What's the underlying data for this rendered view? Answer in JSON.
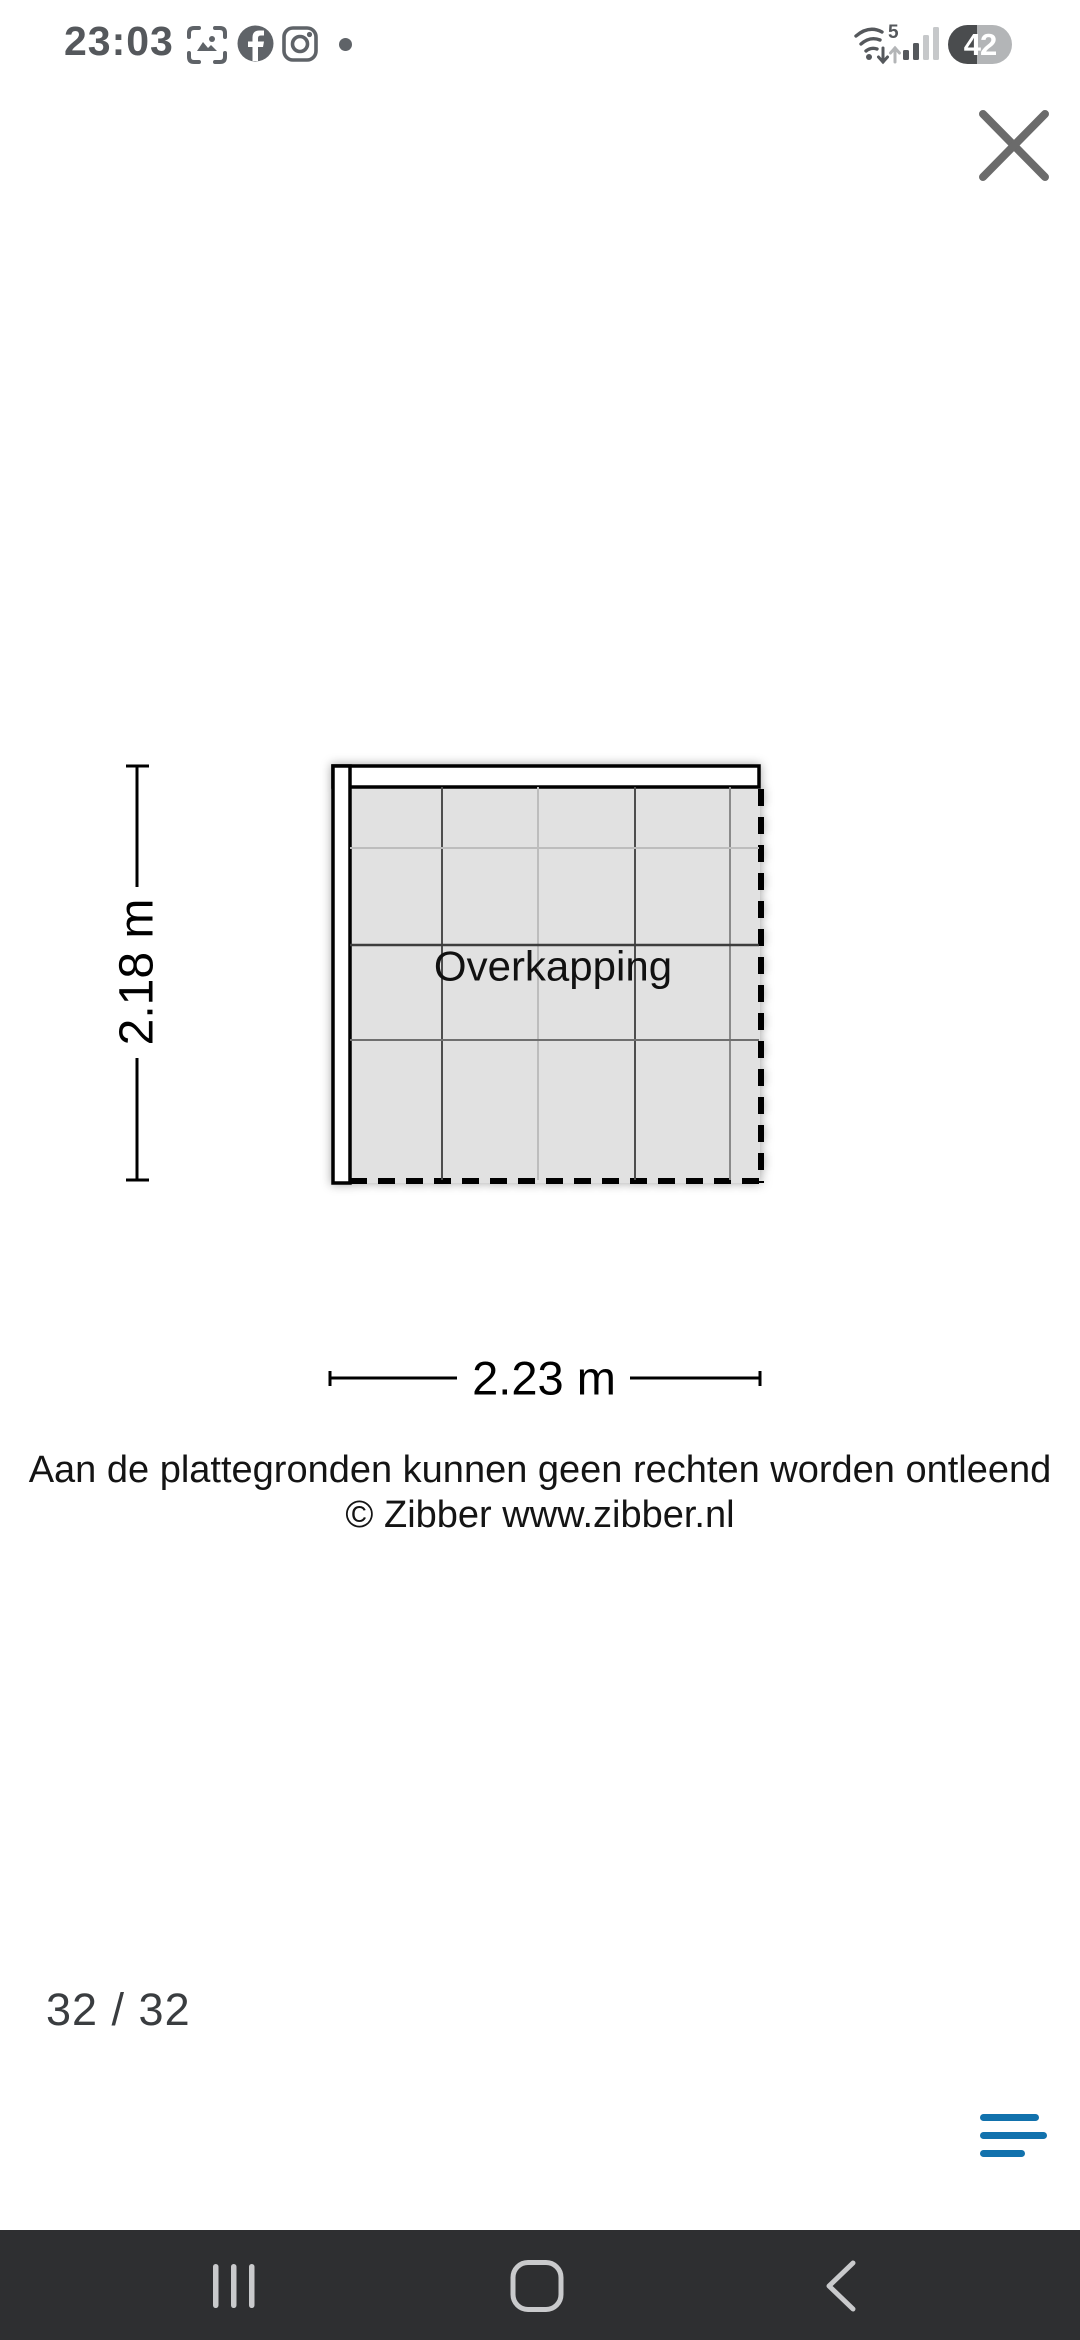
{
  "status_bar": {
    "time": "23:03",
    "wifi_generation": "5",
    "battery_level": "42"
  },
  "floorplan": {
    "room_label": "Overkapping",
    "height_dimension": "2.18 m",
    "width_dimension": "2.23 m"
  },
  "disclaimer": {
    "line1": "Aan de plattegronden kunnen geen rechten worden ontleend",
    "line2": "© Zibber www.zibber.nl"
  },
  "pager": {
    "label": "32 / 32"
  },
  "colors": {
    "menu_accent": "#1272ad",
    "nav_bar_bg": "#2e2f31",
    "nav_icon_gray": "#c9cacc",
    "status_icon_gray": "#5f6368",
    "floor_fill": "#e1e1e1",
    "close_icon_gray": "#6b6b6b"
  }
}
